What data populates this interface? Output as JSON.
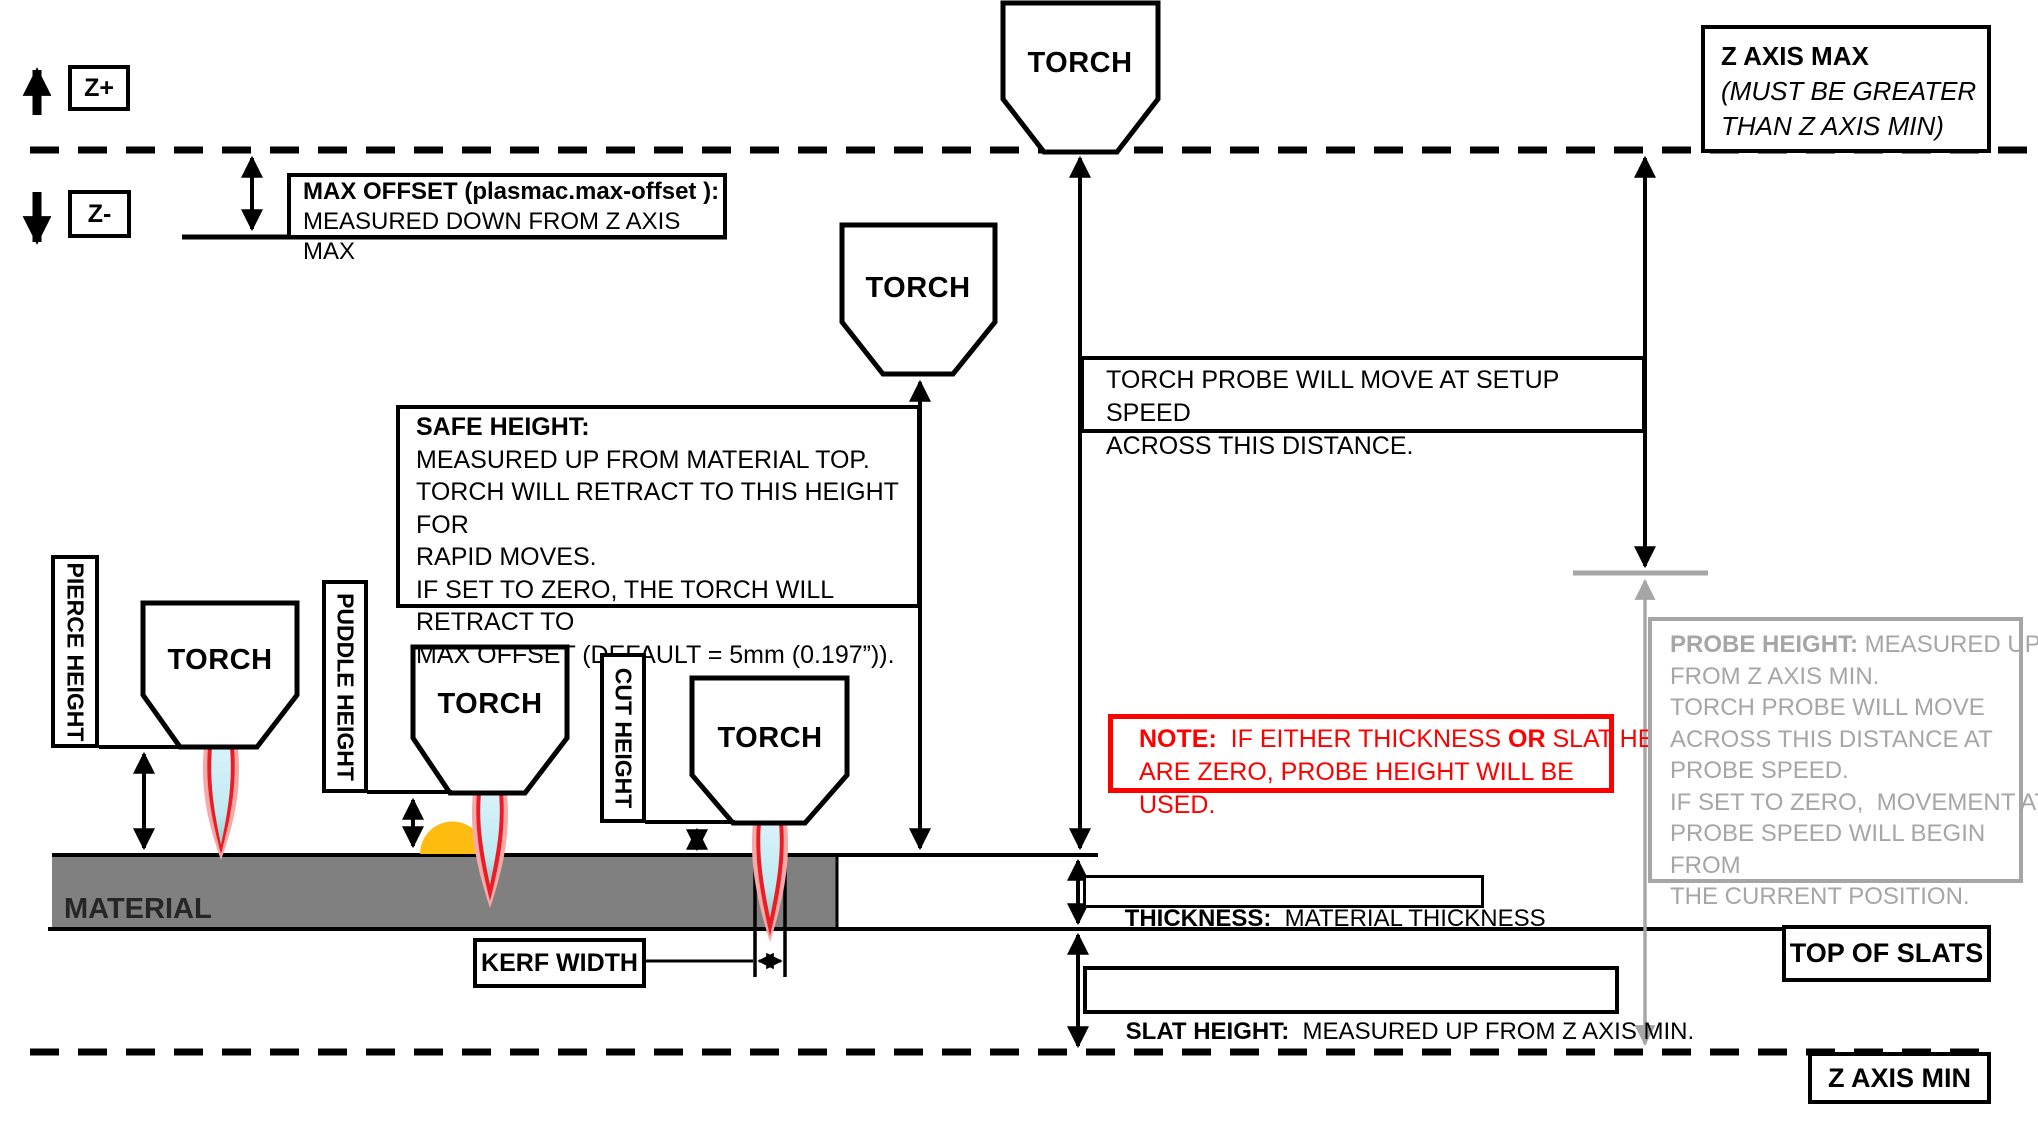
{
  "diagram": {
    "torch_label": "TORCH",
    "material_label": "MATERIAL",
    "axis": {
      "z_plus": "Z+",
      "z_minus": "Z-"
    },
    "boxes": {
      "max_offset": {
        "line1": "MAX OFFSET (plasmac.max-offset ):",
        "line2": "MEASURED DOWN FROM Z AXIS MAX"
      },
      "z_axis_max": {
        "line1": "Z AXIS MAX",
        "line2": "(MUST BE GREATER",
        "line3": "THAN Z AXIS MIN)"
      },
      "torch_probe": {
        "line1": "TORCH PROBE WILL MOVE AT SETUP SPEED",
        "line2": "ACROSS THIS DISTANCE."
      },
      "safe_height": {
        "title": "SAFE HEIGHT:",
        "lines": [
          "MEASURED UP FROM MATERIAL TOP.",
          "TORCH WILL RETRACT TO THIS HEIGHT FOR",
          "RAPID MOVES.",
          "IF SET TO ZERO, THE TORCH WILL RETRACT TO",
          "MAX OFFSET (DEFAULT = 5mm (0.197”))."
        ]
      },
      "note": {
        "bold1": "NOTE:",
        "t1": "  IF EITHER THICKNESS ",
        "bold2": "OR",
        "t2": " SLAT HEIGHT",
        "line2": "ARE ZERO, PROBE HEIGHT WILL BE USED."
      },
      "probe_height": {
        "bold": "PROBE HEIGHT:",
        "rest": " MEASURED UP",
        "lines": [
          "FROM Z AXIS MIN.",
          "TORCH PROBE WILL MOVE",
          "ACROSS THIS DISTANCE AT",
          "PROBE SPEED.",
          "IF SET TO ZERO,  MOVEMENT AT",
          "PROBE SPEED WILL BEGIN FROM",
          "THE CURRENT POSITION."
        ]
      },
      "thickness": {
        "bold": "THICKNESS:",
        "rest": "  MATERIAL THICKNESS"
      },
      "slat_height": {
        "bold": "SLAT HEIGHT:",
        "rest": "  MEASURED UP FROM Z AXIS MIN."
      },
      "kerf_width": "KERF WIDTH",
      "top_of_slats": "TOP OF SLATS",
      "z_axis_min": "Z AXIS MIN",
      "pierce_height": "PIERCE HEIGHT",
      "puddle_height": "PUDDLE HEIGHT",
      "cut_height": "CUT HEIGHT"
    },
    "colors": {
      "note_red": "#ff0000",
      "probe_gray": "#a6a6a6",
      "material_gray": "#808080",
      "flame_red": "#ec1c24",
      "flame_blue": "#c8ecf6",
      "puddle_orange": "#febc11"
    }
  }
}
